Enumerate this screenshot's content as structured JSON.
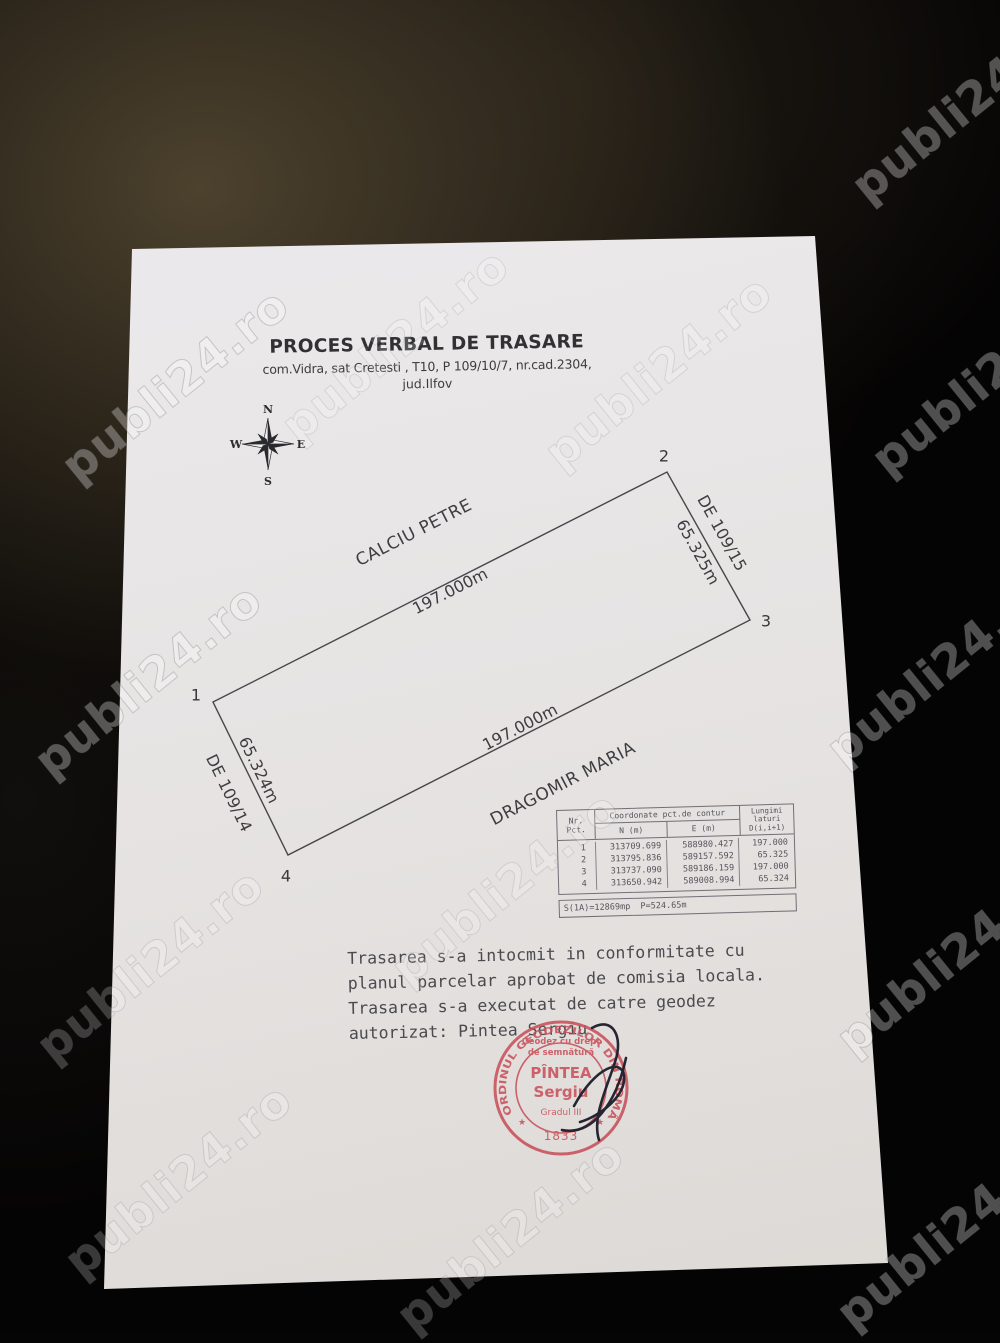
{
  "watermark": {
    "text": "publi24.ro"
  },
  "doc": {
    "title": "PROCES VERBAL DE TRASARE",
    "subtitle1": "com.Vidra, sat Cretesti , T10, P 109/10/7, nr.cad.2304,",
    "subtitle2": "jud.Ilfov",
    "compass": {
      "n": "N",
      "e": "E",
      "s": "S",
      "w": "W"
    },
    "parcel": {
      "corner1": "1",
      "corner2": "2",
      "corner3": "3",
      "corner4": "4",
      "neighbor_top": "CALCIU PETRE",
      "neighbor_bottom": "DRAGOMIR MARIA",
      "road_right": "DE 109/15",
      "road_left": "DE 109/14",
      "length_top": "197.000m",
      "length_bottom": "197.000m",
      "width_right": "65.325m",
      "width_left": "65.324m"
    },
    "table": {
      "h_nr1": "Nr.",
      "h_nr2": "Pct.",
      "h_coord": "Coordonate pct.de contur",
      "h_n": "N (m)",
      "h_e": "E (m)",
      "h_len1": "Lungimi",
      "h_len2": "laturi",
      "h_len3": "D(i,i+1)",
      "rows": [
        {
          "nr": "1",
          "n": "313709.699",
          "e": "588980.427",
          "l": "197.000"
        },
        {
          "nr": "2",
          "n": "313795.836",
          "e": "589157.592",
          "l": "65.325"
        },
        {
          "nr": "3",
          "n": "313737.090",
          "e": "589186.159",
          "l": "197.000"
        },
        {
          "nr": "4",
          "n": "313650.942",
          "e": "589008.994",
          "l": "65.324"
        }
      ],
      "footer": "S(1A)=12869mp  P=524.65m"
    },
    "notes": {
      "line1": "Trasarea s-a intocmit in conformitate cu",
      "line2": "planul parcelar aprobat de comisia locala.",
      "line3": "Trasarea s-a executat de catre geodez",
      "line4": "autorizat: Pintea Sergiu"
    },
    "stamp": {
      "ring": "ORDINUL GEODEZILOR DIN ROMÂNIA",
      "sub1": "Geodez cu drept",
      "sub2": "de semnătură",
      "name1": "PÎNTEA",
      "name2": "Sergiu",
      "grade": "Gradul III",
      "star": "★",
      "number": "1833",
      "color": "#c8505a"
    },
    "colors": {
      "paper": "#e8e6e7",
      "ink": "#3e3e42",
      "stamp_red": "#c8505a",
      "background": "#060505"
    }
  }
}
